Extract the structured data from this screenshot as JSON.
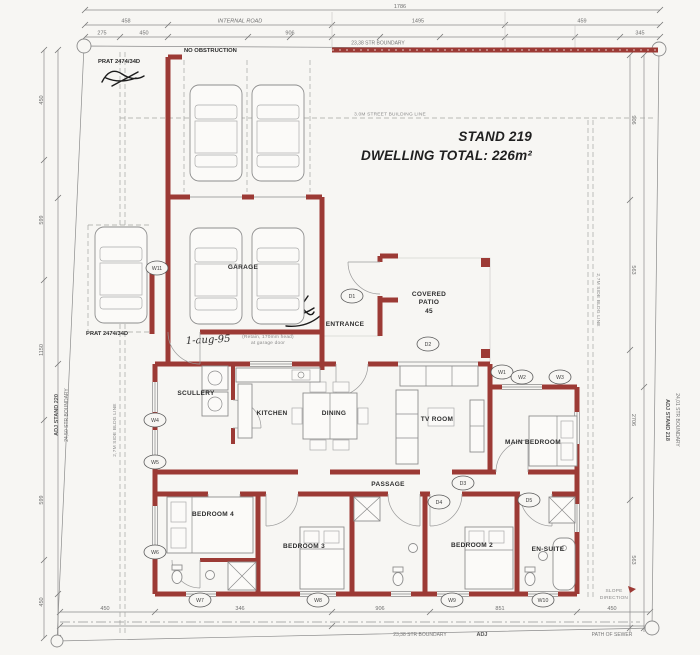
{
  "title": {
    "stand": "STAND 219",
    "total": "DWELLING TOTAL: 226m²"
  },
  "site": {
    "internal_road": "INTERNAL ROAD",
    "no_obstruction": "NO OBSTRUCTION",
    "stamp_top": "PRAT 2474/34D",
    "stamp_left": "PRAT 2474/34D",
    "handwriting": "1-aug-95",
    "garage_note_1": "(Retain, 170mm head)",
    "garage_note_2": "at garage door",
    "street_building_line": "3.0M STREET BUILDING LINE",
    "side_building_line_left": "2,7M SIDE BLDG LINE",
    "side_building_line_right": "2,7M SIDE BLDG LINE",
    "boundary_top": "23,38 STR BOUNDARY",
    "boundary_bottom": "23,38 STR BOUNDARY",
    "adj_bottom": "ADJ",
    "left_adj": "ADJ STAND 220",
    "left_boundary": "24,50 STR BOUNDARY",
    "right_adj": "ADJ STAND 218",
    "right_boundary": "24,01 STR BOUNDARY",
    "sewer": "PATH OF SEWER",
    "slope_1": "SLOPE",
    "slope_2": "DIRECTION"
  },
  "rooms": {
    "garage": "GARAGE",
    "entrance": "ENTRANCE",
    "patio_1": "COVERED",
    "patio_2": "PATIO",
    "patio_3": "45",
    "scullery": "SCULLERY",
    "kitchen": "KITCHEN",
    "dining": "DINING",
    "tv": "TV ROOM",
    "main": "MAIN BEDROOM",
    "passage": "PASSAGE",
    "b4": "BEDROOM 4",
    "b3": "BEDROOM 3",
    "b2": "BEDROOM 2",
    "ensuite": "EN-SUITE"
  },
  "dims": {
    "top": {
      "total": "1786",
      "a": "458",
      "b": "1495",
      "c": "459",
      "d": "275",
      "e": "450",
      "f": "906",
      "g": "345"
    },
    "left": {
      "a": "450",
      "b": "599",
      "c": "1150",
      "d": "599",
      "e": "450"
    },
    "right": {
      "a": "906",
      "b": "563",
      "c": "2706",
      "d": "563"
    },
    "bottom": {
      "a": "450",
      "b": "346",
      "c": "906",
      "d": "851",
      "e": "450"
    }
  },
  "tags": {
    "t1": "D1",
    "t2": "D2",
    "t3": "W1",
    "t4": "W2",
    "t5": "W3",
    "t6": "D3",
    "t7": "D4",
    "t8": "D5",
    "t9": "W4",
    "t10": "W5",
    "t11": "W6",
    "t12": "W7",
    "t13": "W8",
    "t14": "W9",
    "t15": "W10",
    "t16": "W11"
  }
}
